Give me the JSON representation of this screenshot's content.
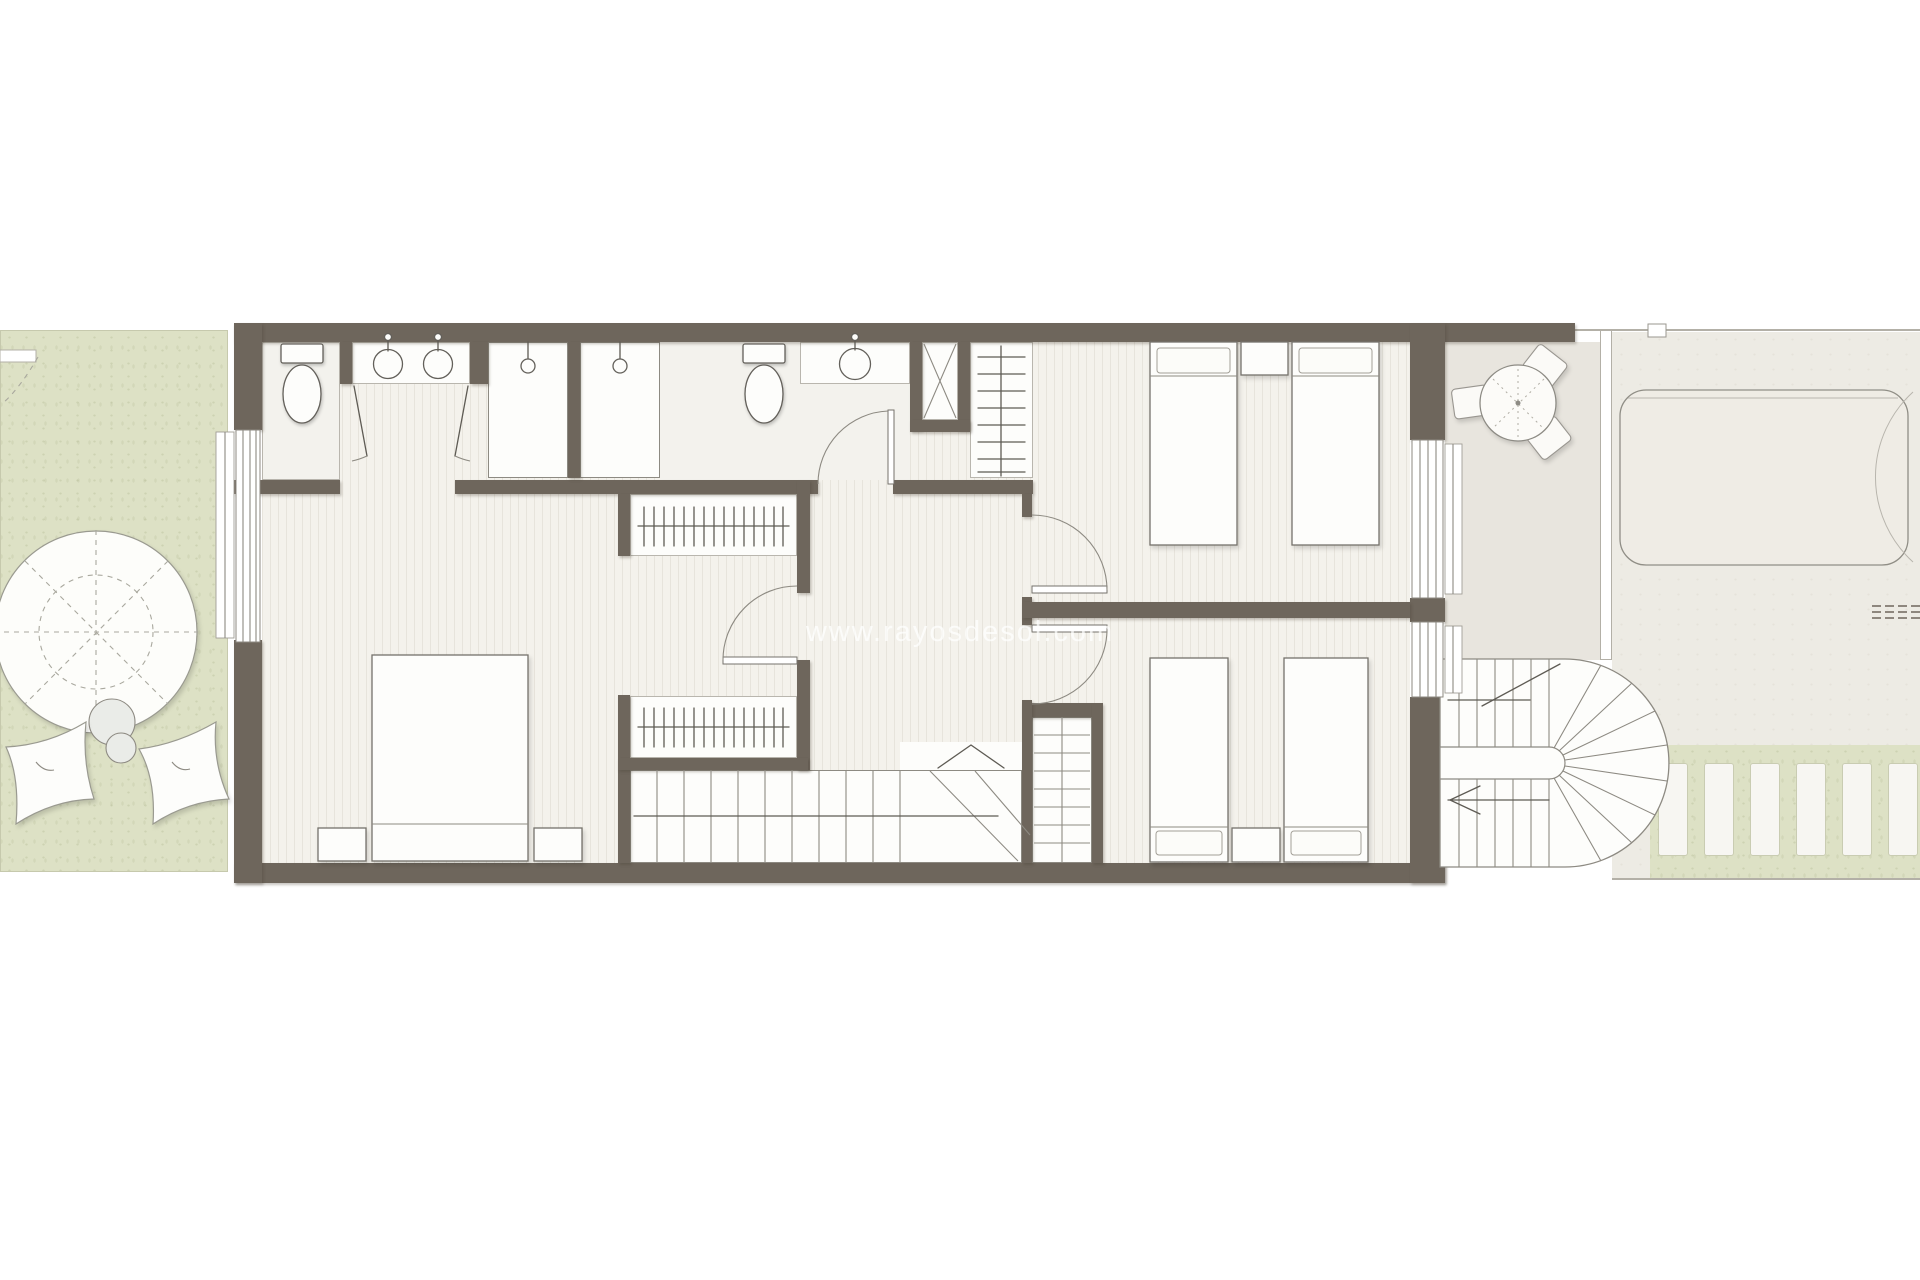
{
  "watermark": {
    "text": "www.rayosdesol.com"
  },
  "colors": {
    "wall": "#6e665c",
    "floor_base": "#f4f2ec",
    "floor_stripe": "#e7e4dc",
    "room_white": "#fdfdfb",
    "bath_floor": "#f3f2ed",
    "garden_green": "#dde1c5",
    "terrace": "#e8e5de",
    "neighbor": "#edebe4",
    "line_dark": "#5e5b54",
    "line_mid": "#8d8a82",
    "line_light": "#b9b6ae",
    "watermark_color": "rgba(255,255,255,0.72)"
  }
}
